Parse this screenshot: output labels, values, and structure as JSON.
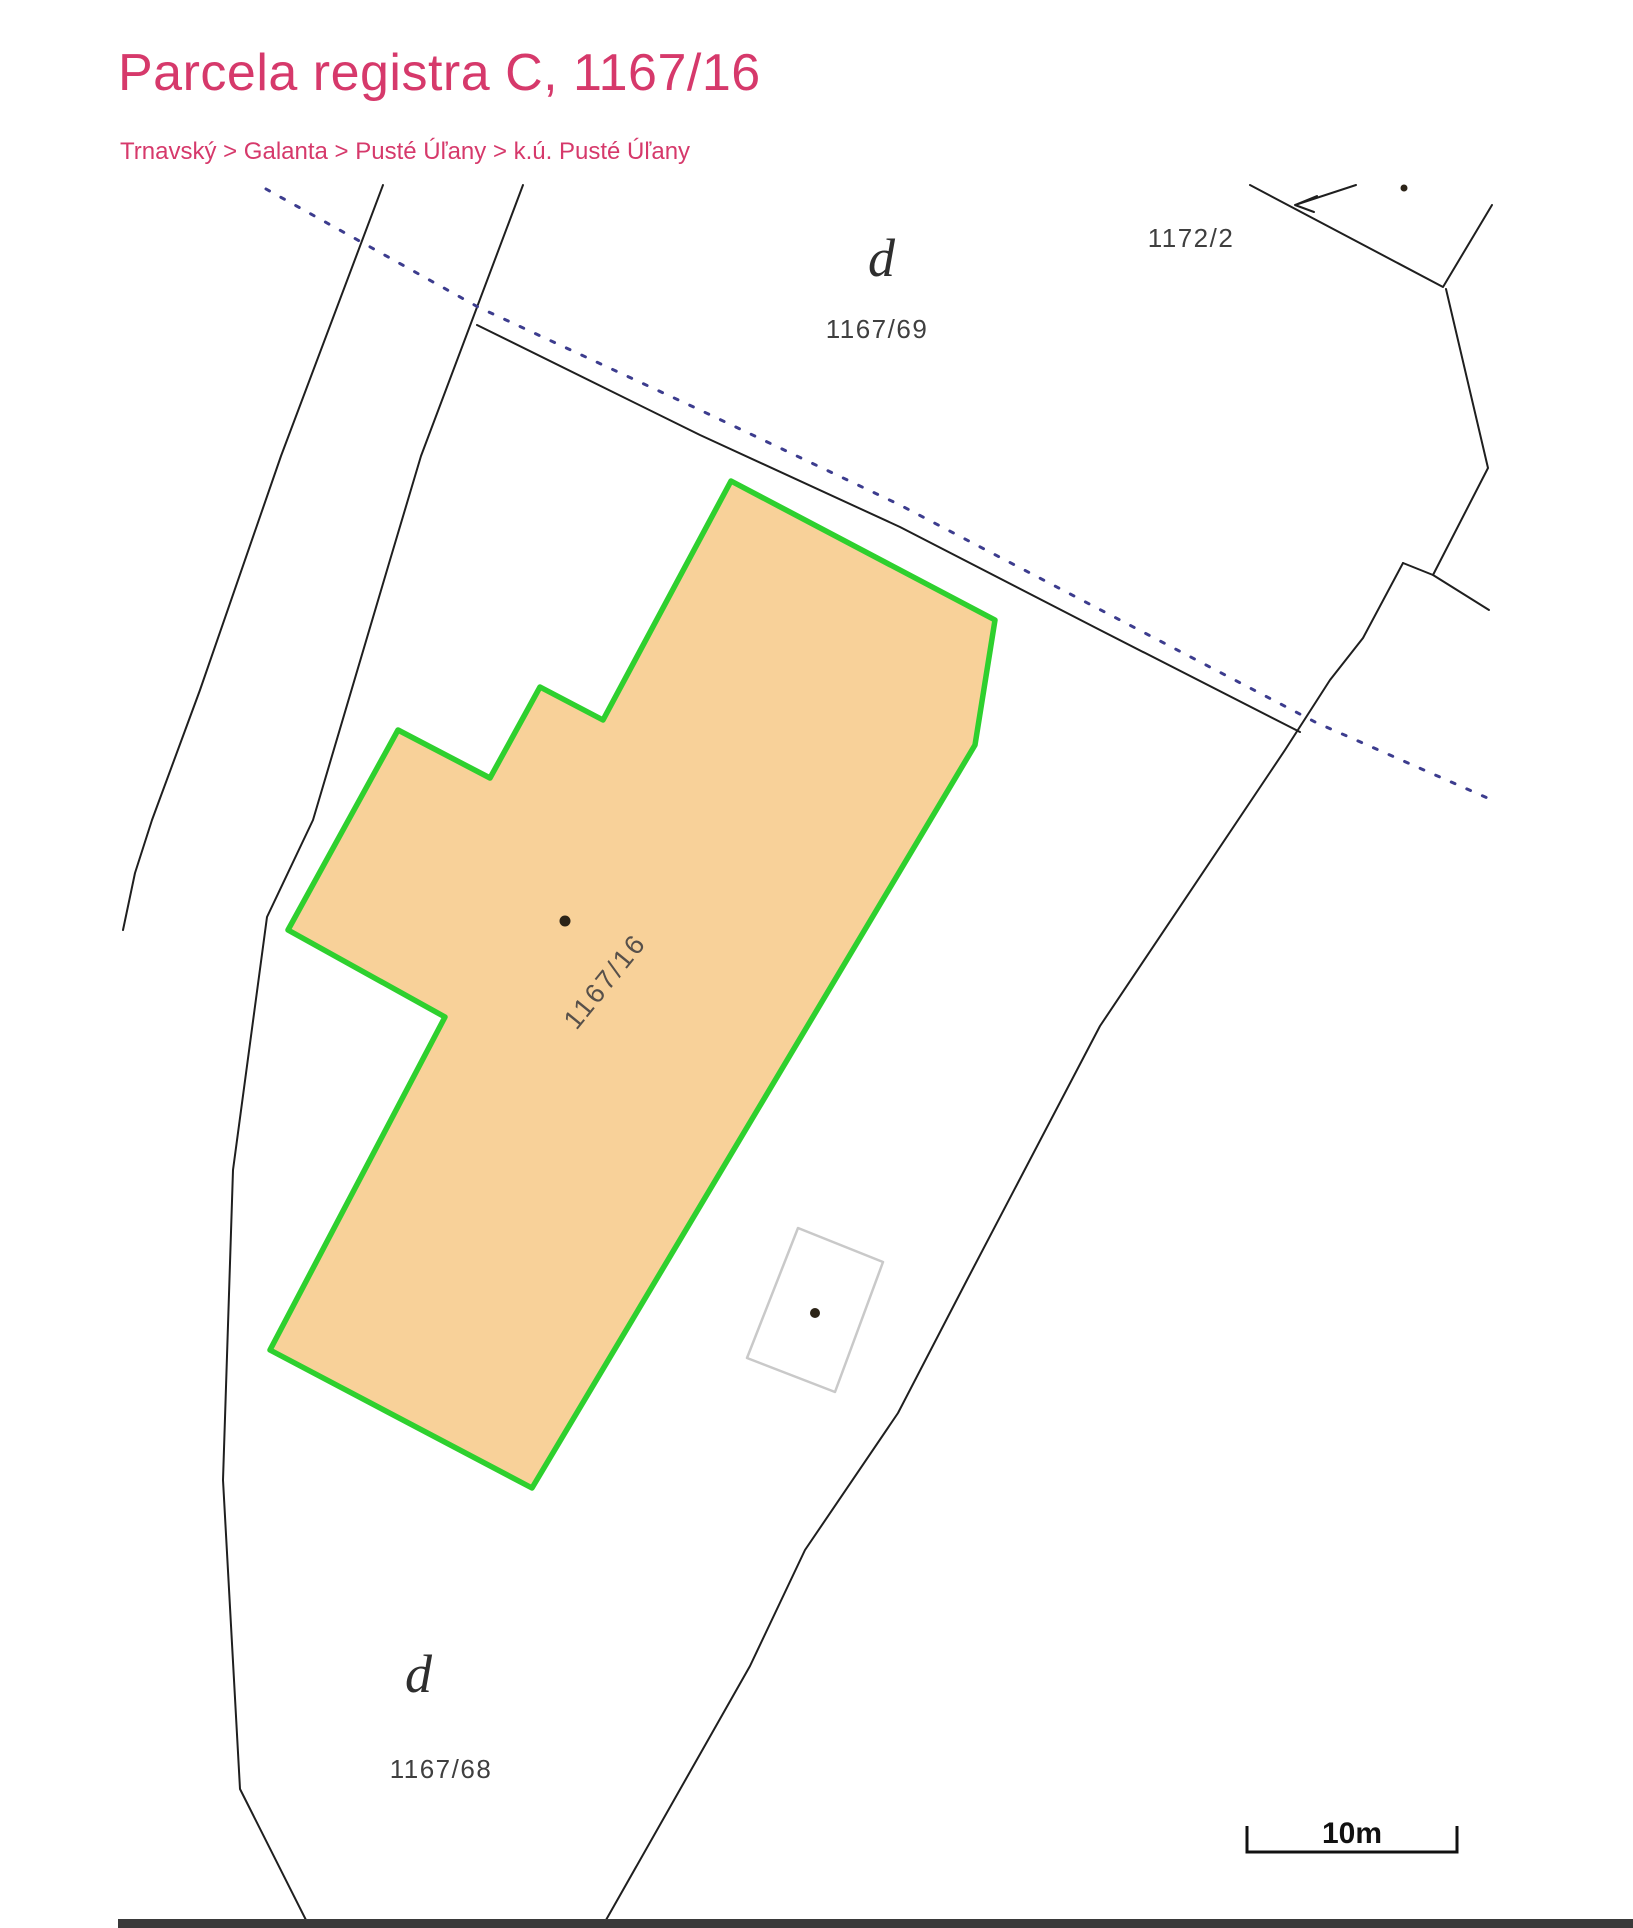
{
  "theme": {
    "accent": "#d6396b",
    "map-line": "#1f1f1f",
    "dotted-line": "#3c3c8e",
    "parcel-fill": "#f8d199",
    "parcel-stroke": "#2ed02e",
    "building-stroke": "#c9c9c9",
    "label-color": "#3f3f3f",
    "symbol-color": "#2e2e2e",
    "highlight-label-color": "#57504a",
    "scalebar-color": "#111111",
    "footer-strip": "#3a3a3a"
  },
  "header": {
    "title": "Parcela registra C, 1167/16",
    "breadcrumb": "Trnavský > Galanta > Pusté Úľany > k.ú. Pusté Úľany"
  },
  "map": {
    "labels": {
      "d_top": "d",
      "parcel_1167_69": "1167/69",
      "parcel_1172_2": "1172/2",
      "d_bottom": "d",
      "parcel_1167_68": "1167/68",
      "highlight": "1167/16"
    },
    "scalebar": {
      "label": "10m"
    },
    "geometry": {
      "boundary_left_a": "383,185 281,456 200,690 152,820 135,873 123,930",
      "boundary_left_b": "523,185 421,456 390,560 313,820 267,917 233,1170 223,1480 240,1789 310,1928",
      "road_edge": "477,325 700,435 900,527 1100,630 1300,732",
      "dotted_boundary": "266,189 478,307 700,410 900,505 1315,722 1492,800",
      "east_boundary": "1403,563 1363,638 1330,680 1285,750 1100,1026 967,1280 898,1413 805,1550 750,1666 606,1920",
      "building_v": "1250,185 1443,287 1492,205",
      "building_step": "1446,289 1488,468 1433,575 1403,563",
      "building_spur": "1433,575 1489,610",
      "arrow_shaft": "M1356,185 L1295,205 M1295,205 L1317,196 M1295,205 L1314,212",
      "highlight_parcel": "731,481 995,620 975,745 532,1488 270,1350 445,1017 288,930 398,730 490,778 540,687 603,720",
      "small_building": "798,1228 883,1262 835,1392 747,1358",
      "scalebar_path": "M1247,1826 L1247,1852 L1457,1852 L1457,1826"
    }
  }
}
